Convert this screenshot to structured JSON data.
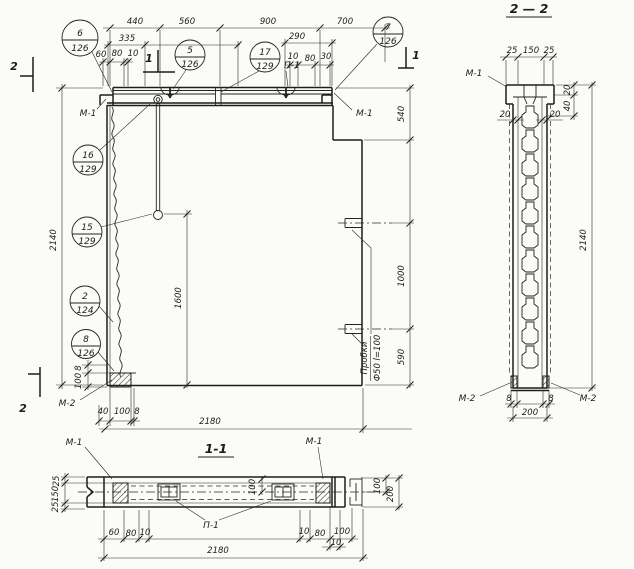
{
  "titles": {
    "s11": "1-1",
    "s22": "2 — 2"
  },
  "labels": {
    "m1": "М-1",
    "m2": "М-2",
    "p1": "П-1"
  },
  "note": {
    "l1": "Пробки",
    "l2": "Ф50 l=100"
  },
  "markers": {
    "one": "1",
    "two": "2"
  },
  "callouts": {
    "c6": {
      "num": "6",
      "sheet": "126"
    },
    "c5": {
      "num": "5",
      "sheet": "126"
    },
    "c17": {
      "num": "17",
      "sheet": "129"
    },
    "c7": {
      "num": "7",
      "sheet": "126"
    },
    "c16": {
      "num": "16",
      "sheet": "129"
    },
    "c15": {
      "num": "15",
      "sheet": "129"
    },
    "c2": {
      "num": "2",
      "sheet": "124"
    },
    "c8": {
      "num": "8",
      "sheet": "126"
    }
  },
  "dims": {
    "top": [
      "440",
      "560",
      "900",
      "700"
    ],
    "d335": "335",
    "d290": "290",
    "sl": [
      "60",
      "80",
      "10"
    ],
    "sr": [
      "10",
      "80",
      "30"
    ],
    "h": "2140",
    "v8": "8",
    "v100": "100",
    "blk": [
      "40",
      "100",
      "8"
    ],
    "w": "2180",
    "r540": "540",
    "r1000": "1000",
    "r590": "590",
    "rod": "1600",
    "s22_top": [
      "25",
      "150",
      "25"
    ],
    "s22_20l": "20",
    "s22_20r": "20",
    "s22_r20": "20",
    "s22_r40": "40",
    "s22_h": "2140",
    "s22_8l": "8",
    "s22_8r": "8",
    "s22_200": "200",
    "s11_l": [
      "25",
      "150",
      "25"
    ],
    "s11_bl": [
      "60",
      "80",
      "10"
    ],
    "s11_br": [
      "10",
      "80",
      "100"
    ],
    "s11_b10": "10",
    "s11_m100": "100",
    "s11_w": "2180",
    "s11_p100": "100",
    "s11_p200": "200"
  }
}
